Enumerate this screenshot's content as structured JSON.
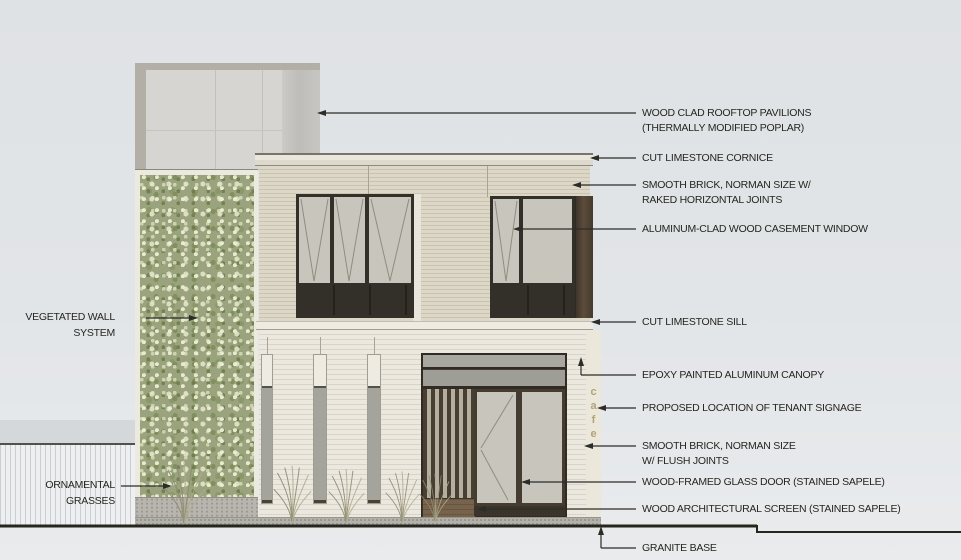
{
  "signage": {
    "letters": [
      "c",
      "a",
      "f",
      "e"
    ]
  },
  "callouts_right": [
    {
      "line1": "WOOD CLAD ROOFTOP PAVILIONS",
      "line2": "(THERMALLY MODIFIED POPLAR)"
    },
    {
      "line1": "CUT LIMESTONE CORNICE",
      "line2": ""
    },
    {
      "line1": "SMOOTH BRICK, NORMAN SIZE W/",
      "line2": "RAKED HORIZONTAL JOINTS"
    },
    {
      "line1": "ALUMINUM-CLAD WOOD CASEMENT WINDOW",
      "line2": ""
    },
    {
      "line1": "CUT LIMESTONE SILL",
      "line2": ""
    },
    {
      "line1": "EPOXY PAINTED ALUMINUM CANOPY",
      "line2": ""
    },
    {
      "line1": "PROPOSED LOCATION OF TENANT SIGNAGE",
      "line2": ""
    },
    {
      "line1": "SMOOTH BRICK, NORMAN SIZE",
      "line2": "W/ FLUSH JOINTS"
    },
    {
      "line1": "WOOD-FRAMED GLASS DOOR (STAINED SAPELE)",
      "line2": ""
    },
    {
      "line1": "WOOD ARCHITECTURAL SCREEN (STAINED SAPELE)",
      "line2": ""
    },
    {
      "line1": "GRANITE BASE",
      "line2": ""
    }
  ],
  "callouts_left": [
    {
      "line1": "VEGETATED WALL",
      "line2": "SYSTEM"
    },
    {
      "line1": "ORNAMENTAL",
      "line2": "GRASSES"
    }
  ],
  "colors": {
    "sky": "#e0e3e6",
    "brick_upper": "#ddd7c8",
    "brick_ground": "#ebe8df",
    "limestone": "#eae6dc",
    "window_frame": "#33302a",
    "glass": "#c8c6bc",
    "sapele_wood": "#473e33",
    "wood_panel": "#77634b",
    "canopy": "#a8a8a0",
    "vegetated_wall": "#9aa37e",
    "granite": "#b3b1a9",
    "signage_text": "#b1a379",
    "leader_line": "#2c2c28"
  }
}
